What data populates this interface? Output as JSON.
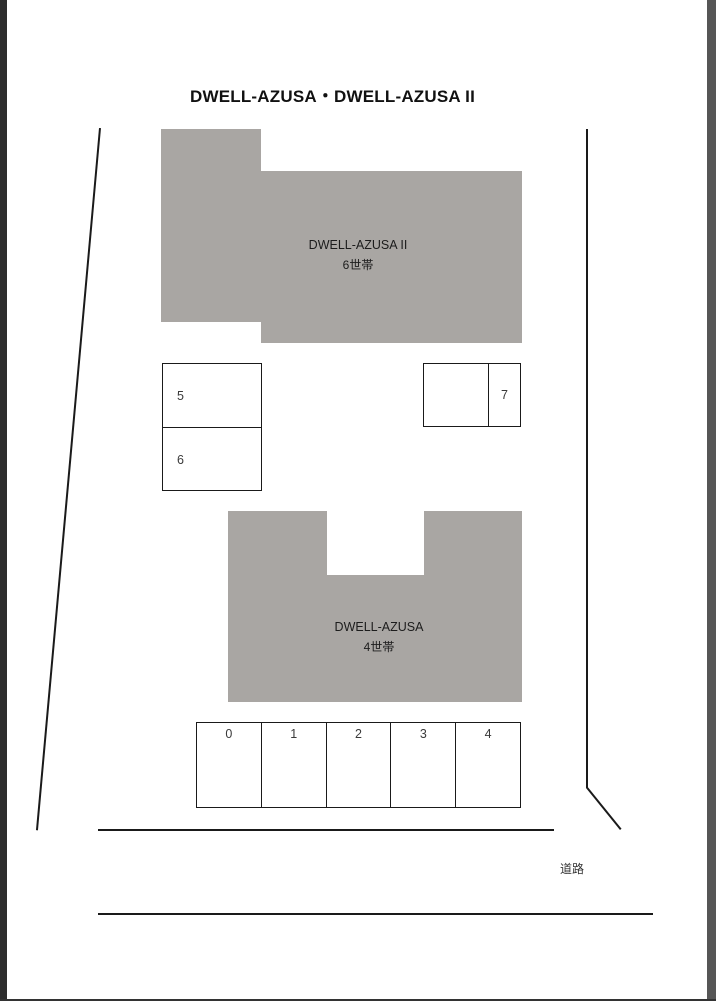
{
  "title": "DWELL-AZUSA・DWELL-AZUSA II",
  "buildings": [
    {
      "name": "DWELL-AZUSA II",
      "units": "6世帯"
    },
    {
      "name": "DWELL-AZUSA",
      "units": "4世帯"
    }
  ],
  "parking": {
    "left_block": [
      "5",
      "6"
    ],
    "right_block": [
      "7"
    ],
    "bottom_row": [
      "0",
      "1",
      "2",
      "3",
      "4"
    ]
  },
  "road_label": "道路",
  "colors": {
    "building_fill": "#a9a6a3",
    "line": "#1a1a1a",
    "number_text": "#3a3a3a",
    "building_text": "#1c1c1c"
  }
}
